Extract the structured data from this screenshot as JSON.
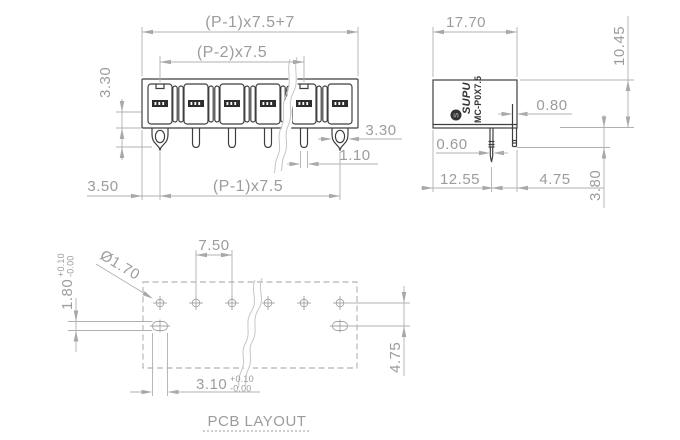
{
  "drawing": {
    "front_view": {
      "overall_width": "(P-1)x7.5+7",
      "inner_pitch": "(P-2)x7.5",
      "body_height": "3.30",
      "left_margin": "3.50",
      "pin_span": "(P-1)x7.5",
      "anchor_pin_width": "3.30",
      "pin_width": "1.10"
    },
    "side_view": {
      "depth": "17.70",
      "height": "10.45",
      "pin_thickness": "0.80",
      "peg_thickness": "0.60",
      "peg_offset": "12.55",
      "pin_offset": "4.75",
      "pin_length": "3.80",
      "brand": "SUPU",
      "logo_letter": "S",
      "model": "MC-P0X7.5"
    },
    "pcb_layout": {
      "title": "PCB LAYOUT",
      "hole_pitch": "7.50",
      "hole_diameter": "Ø1.70",
      "slot_height": "1.80",
      "slot_width": "3.10",
      "tolerance_plus": "+0.10",
      "tolerance_minus": "-0.00",
      "row_spacing": "4.75"
    }
  },
  "colors": {
    "part_line": "#3f3f3f",
    "dimension_line": "#b0b0b0",
    "dimension_text": "#9c9c9c",
    "background": "#ffffff"
  }
}
